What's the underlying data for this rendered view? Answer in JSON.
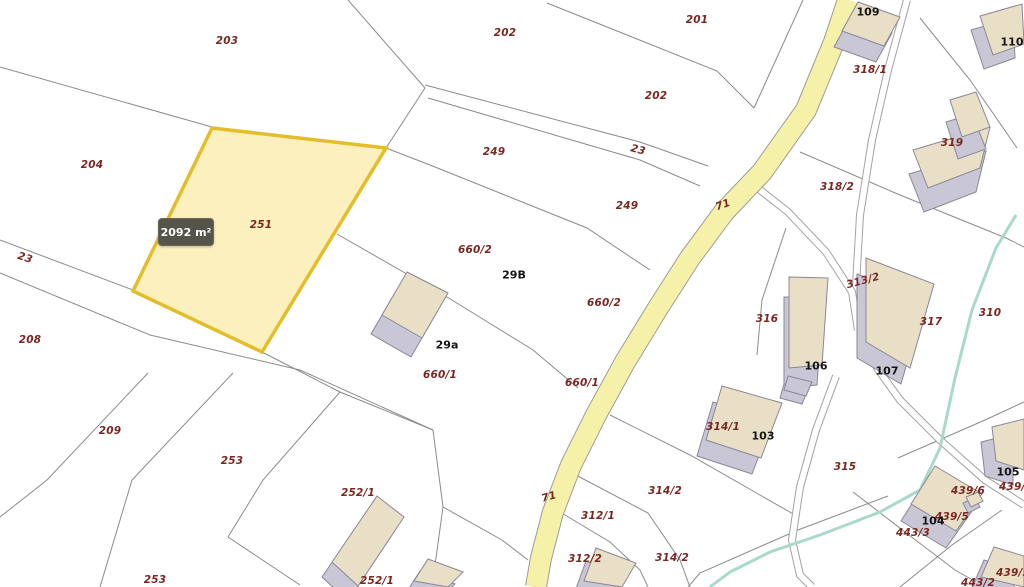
{
  "tooltip": {
    "area_label": "2092 m²"
  },
  "map": {
    "colors": {
      "background": "#ffffff",
      "boundary": "#8b8b8b",
      "road_fill": "#f6f1a8",
      "road_casing": "#9c9c9c",
      "path_edge": "#a2a2a2",
      "path_fill": "#ffffff",
      "stream": "#a9d9cb",
      "bldg_roof": "#e9dfc6",
      "bldg_side": "#c9c6d6",
      "bldg_edge": "#8a8795",
      "sel_fill": "#f6de6e",
      "sel_stroke": "#e4bd2a",
      "parcel_label": "#7a2721",
      "building_label": "#141414",
      "tooltip_bg": "#56544a"
    },
    "selected_parcel": {
      "id": "251",
      "area_label": "2092 m²",
      "points": [
        [
          212,
          128
        ],
        [
          386,
          148
        ],
        [
          262,
          352
        ],
        [
          133,
          291
        ]
      ]
    },
    "road": {
      "id": "71",
      "centerline": [
        [
          848,
          0
        ],
        [
          834,
          42
        ],
        [
          806,
          110
        ],
        [
          762,
          172
        ],
        [
          724,
          212
        ],
        [
          690,
          258
        ],
        [
          658,
          308
        ],
        [
          625,
          362
        ],
        [
          596,
          415
        ],
        [
          571,
          465
        ],
        [
          553,
          512
        ],
        [
          541,
          558
        ],
        [
          536,
          587
        ]
      ],
      "width": 20
    },
    "paths": [
      [
        [
          907,
          0
        ],
        [
          888,
          70
        ],
        [
          872,
          140
        ],
        [
          860,
          215
        ],
        [
          856,
          285
        ],
        [
          862,
          330
        ],
        [
          877,
          368
        ],
        [
          900,
          400
        ],
        [
          940,
          440
        ],
        [
          985,
          480
        ],
        [
          1024,
          505
        ]
      ],
      [
        [
          750,
          182
        ],
        [
          788,
          212
        ],
        [
          826,
          252
        ],
        [
          852,
          292
        ],
        [
          858,
          330
        ]
      ],
      [
        [
          836,
          376
        ],
        [
          816,
          430
        ],
        [
          800,
          487
        ],
        [
          792,
          540
        ],
        [
          800,
          575
        ],
        [
          812,
          587
        ]
      ]
    ],
    "stream": [
      [
        1016,
        215
      ],
      [
        996,
        248
      ],
      [
        972,
        310
      ],
      [
        955,
        378
      ],
      [
        940,
        448
      ],
      [
        920,
        490
      ],
      [
        880,
        512
      ],
      [
        820,
        535
      ],
      [
        770,
        552
      ],
      [
        730,
        572
      ],
      [
        710,
        587
      ]
    ],
    "boundaries": [
      [
        [
          0,
          67
        ],
        [
          212,
          127
        ]
      ],
      [
        [
          212,
          127
        ],
        [
          386,
          148
        ]
      ],
      [
        [
          348,
          0
        ],
        [
          425,
          88
        ]
      ],
      [
        [
          425,
          88
        ],
        [
          386,
          148
        ]
      ],
      [
        [
          547,
          3
        ],
        [
          717,
          71
        ],
        [
          754,
          108
        ]
      ],
      [
        [
          754,
          108
        ],
        [
          803,
          0
        ]
      ],
      [
        [
          425,
          85
        ],
        [
          640,
          142
        ],
        [
          708,
          166
        ]
      ],
      [
        [
          428,
          98
        ],
        [
          640,
          160
        ],
        [
          700,
          186
        ]
      ],
      [
        [
          386,
          148
        ],
        [
          430,
          165
        ],
        [
          587,
          228
        ],
        [
          650,
          270
        ]
      ],
      [
        [
          337,
          234
        ],
        [
          447,
          297
        ],
        [
          533,
          350
        ],
        [
          578,
          388
        ]
      ],
      [
        [
          0,
          240
        ],
        [
          133,
          290
        ]
      ],
      [
        [
          0,
          273
        ],
        [
          150,
          335
        ],
        [
          300,
          370
        ],
        [
          433,
          430
        ]
      ],
      [
        [
          262,
          352
        ],
        [
          340,
          392
        ],
        [
          433,
          430
        ]
      ],
      [
        [
          433,
          430
        ],
        [
          443,
          507
        ],
        [
          432,
          587
        ]
      ],
      [
        [
          443,
          507
        ],
        [
          502,
          540
        ],
        [
          528,
          560
        ]
      ],
      [
        [
          148,
          373
        ],
        [
          47,
          480
        ],
        [
          0,
          517
        ]
      ],
      [
        [
          233,
          373
        ],
        [
          132,
          480
        ],
        [
          100,
          587
        ]
      ],
      [
        [
          340,
          392
        ],
        [
          263,
          480
        ],
        [
          228,
          537
        ],
        [
          300,
          585
        ]
      ],
      [
        [
          920,
          18
        ],
        [
          970,
          80
        ],
        [
          1017,
          148
        ]
      ],
      [
        [
          800,
          152
        ],
        [
          900,
          195
        ],
        [
          1006,
          238
        ],
        [
          1024,
          247
        ]
      ],
      [
        [
          610,
          415
        ],
        [
          690,
          455
        ],
        [
          760,
          495
        ],
        [
          795,
          515
        ]
      ],
      [
        [
          572,
          473
        ],
        [
          648,
          513
        ],
        [
          680,
          560
        ],
        [
          690,
          587
        ]
      ],
      [
        [
          560,
          512
        ],
        [
          610,
          542
        ],
        [
          640,
          570
        ],
        [
          648,
          587
        ]
      ],
      [
        [
          888,
          496
        ],
        [
          798,
          530
        ],
        [
          700,
          573
        ],
        [
          688,
          587
        ]
      ],
      [
        [
          853,
          492
        ],
        [
          905,
          532
        ],
        [
          955,
          570
        ],
        [
          985,
          587
        ]
      ],
      [
        [
          898,
          458
        ],
        [
          985,
          420
        ]
      ],
      [
        [
          985,
          420
        ],
        [
          1024,
          402
        ]
      ],
      [
        [
          900,
          587
        ],
        [
          952,
          545
        ],
        [
          1002,
          510
        ]
      ],
      [
        [
          786,
          228
        ],
        [
          762,
          300
        ],
        [
          757,
          355
        ]
      ]
    ],
    "buildings": [
      {
        "n": "building-109",
        "roof": [
          [
            858,
            2
          ],
          [
            900,
            17
          ],
          [
            884,
            46
          ],
          [
            842,
            31
          ]
        ],
        "ex": [
          -8,
          16
        ]
      },
      {
        "n": "building-110",
        "roof": [
          [
            980,
            16
          ],
          [
            1022,
            4
          ],
          [
            1024,
            44
          ],
          [
            993,
            55
          ]
        ],
        "ex": [
          -9,
          14
        ]
      },
      {
        "n": "building-319-main",
        "roof": [
          [
            913,
            150
          ],
          [
            990,
            127
          ],
          [
            980,
            168
          ],
          [
            928,
            188
          ]
        ],
        "ex": [
          -4,
          24
        ]
      },
      {
        "n": "building-319-wing",
        "roof": [
          [
            950,
            100
          ],
          [
            976,
            92
          ],
          [
            990,
            127
          ],
          [
            962,
            137
          ]
        ],
        "ex": [
          -4,
          22
        ]
      },
      {
        "n": "building-29a",
        "roof": [
          [
            407,
            272
          ],
          [
            448,
            293
          ],
          [
            422,
            338
          ],
          [
            382,
            315
          ]
        ],
        "ex": [
          -11,
          19
        ]
      },
      {
        "n": "building-106",
        "roof": [
          [
            789,
            277
          ],
          [
            828,
            278
          ],
          [
            822,
            365
          ],
          [
            789,
            368
          ]
        ],
        "ex": [
          -5,
          20
        ]
      },
      {
        "n": "building-107",
        "roof": [
          [
            866,
            258
          ],
          [
            934,
            284
          ],
          [
            910,
            368
          ],
          [
            866,
            342
          ]
        ],
        "ex": [
          -9,
          16
        ]
      },
      {
        "n": "building-103",
        "roof": [
          [
            722,
            386
          ],
          [
            782,
            403
          ],
          [
            761,
            458
          ],
          [
            706,
            440
          ]
        ],
        "ex": [
          -9,
          16
        ]
      },
      {
        "n": "building-small-annex",
        "roof": [
          [
            788,
            376
          ],
          [
            812,
            382
          ],
          [
            806,
            396
          ],
          [
            784,
            390
          ]
        ],
        "ex": [
          -4,
          8
        ],
        "gray": true
      },
      {
        "n": "building-252",
        "roof": [
          [
            377,
            496
          ],
          [
            404,
            517
          ],
          [
            358,
            586
          ],
          [
            332,
            562
          ]
        ],
        "ex": [
          -10,
          15
        ]
      },
      {
        "n": "building-bottom-center",
        "roof": [
          [
            428,
            559
          ],
          [
            463,
            572
          ],
          [
            448,
            587
          ],
          [
            414,
            581
          ]
        ],
        "ex": [
          -8,
          12
        ]
      },
      {
        "n": "building-312",
        "roof": [
          [
            596,
            548
          ],
          [
            636,
            563
          ],
          [
            622,
            587
          ],
          [
            584,
            581
          ]
        ],
        "ex": [
          -10,
          13
        ]
      },
      {
        "n": "building-104",
        "roof": [
          [
            935,
            466
          ],
          [
            982,
            494
          ],
          [
            956,
            531
          ],
          [
            911,
            504
          ]
        ],
        "ex": [
          -10,
          17
        ]
      },
      {
        "n": "building-105",
        "roof": [
          [
            992,
            427
          ],
          [
            1024,
            419
          ],
          [
            1024,
            470
          ],
          [
            996,
            461
          ]
        ],
        "ex": [
          -11,
          15
        ]
      },
      {
        "n": "building-439-5",
        "roof": [
          [
            994,
            547
          ],
          [
            1024,
            556
          ],
          [
            1024,
            587
          ],
          [
            981,
            577
          ]
        ],
        "ex": [
          -10,
          13
        ]
      },
      {
        "n": "building-nub",
        "roof": [
          [
            966,
            497
          ],
          [
            978,
            492
          ],
          [
            983,
            501
          ],
          [
            971,
            507
          ]
        ],
        "ex": [
          -3,
          6
        ]
      }
    ],
    "labels": [
      {
        "t": "203",
        "x": 227,
        "y": 41,
        "c": "p"
      },
      {
        "t": "202",
        "x": 505,
        "y": 33,
        "c": "p"
      },
      {
        "t": "201",
        "x": 697,
        "y": 20,
        "c": "p"
      },
      {
        "t": "202",
        "x": 656,
        "y": 96,
        "c": "p"
      },
      {
        "t": "204",
        "x": 92,
        "y": 165,
        "c": "p"
      },
      {
        "t": "249",
        "x": 494,
        "y": 152,
        "c": "p"
      },
      {
        "t": "23",
        "x": 638,
        "y": 150,
        "c": "p",
        "r": 15
      },
      {
        "t": "249",
        "x": 627,
        "y": 206,
        "c": "p"
      },
      {
        "t": "318/1",
        "x": 870,
        "y": 70,
        "c": "p"
      },
      {
        "t": "319",
        "x": 952,
        "y": 143,
        "c": "p"
      },
      {
        "t": "318/2",
        "x": 837,
        "y": 187,
        "c": "p"
      },
      {
        "t": "71",
        "x": 723,
        "y": 205,
        "c": "p",
        "r": -20
      },
      {
        "t": "23",
        "x": 25,
        "y": 258,
        "c": "p",
        "r": 18
      },
      {
        "t": "251",
        "x": 261,
        "y": 225,
        "c": "p"
      },
      {
        "t": "660/2",
        "x": 475,
        "y": 250,
        "c": "p"
      },
      {
        "t": "660/2",
        "x": 604,
        "y": 303,
        "c": "p"
      },
      {
        "t": "313/2",
        "x": 863,
        "y": 281,
        "c": "p",
        "r": -15
      },
      {
        "t": "316",
        "x": 767,
        "y": 319,
        "c": "p"
      },
      {
        "t": "317",
        "x": 931,
        "y": 322,
        "c": "p"
      },
      {
        "t": "310",
        "x": 990,
        "y": 313,
        "c": "p"
      },
      {
        "t": "208",
        "x": 30,
        "y": 340,
        "c": "p"
      },
      {
        "t": "660/1",
        "x": 440,
        "y": 375,
        "c": "p"
      },
      {
        "t": "660/1",
        "x": 582,
        "y": 383,
        "c": "p"
      },
      {
        "t": "209",
        "x": 110,
        "y": 431,
        "c": "p"
      },
      {
        "t": "314/1",
        "x": 723,
        "y": 427,
        "c": "p"
      },
      {
        "t": "253",
        "x": 232,
        "y": 461,
        "c": "p"
      },
      {
        "t": "315",
        "x": 845,
        "y": 467,
        "c": "p"
      },
      {
        "t": "252/1",
        "x": 358,
        "y": 493,
        "c": "p"
      },
      {
        "t": "312/1",
        "x": 598,
        "y": 516,
        "c": "p"
      },
      {
        "t": "439/6",
        "x": 968,
        "y": 491,
        "c": "p"
      },
      {
        "t": "439/5",
        "x": 952,
        "y": 517,
        "c": "p"
      },
      {
        "t": "443/3",
        "x": 913,
        "y": 533,
        "c": "p"
      },
      {
        "t": "314/2",
        "x": 665,
        "y": 491,
        "c": "p"
      },
      {
        "t": "312/2",
        "x": 585,
        "y": 559,
        "c": "p"
      },
      {
        "t": "314/2",
        "x": 672,
        "y": 558,
        "c": "p"
      },
      {
        "t": "71",
        "x": 549,
        "y": 497,
        "c": "p",
        "r": -15
      },
      {
        "t": "439/4",
        "x": 1016,
        "y": 487,
        "c": "p"
      },
      {
        "t": "439/5",
        "x": 1013,
        "y": 573,
        "c": "p"
      },
      {
        "t": "443/2",
        "x": 978,
        "y": 583,
        "c": "p"
      },
      {
        "t": "252/1",
        "x": 377,
        "y": 581,
        "c": "p"
      },
      {
        "t": "253",
        "x": 155,
        "y": 580,
        "c": "p"
      },
      {
        "t": "109",
        "x": 868,
        "y": 12,
        "c": "b"
      },
      {
        "t": "110",
        "x": 1012,
        "y": 42,
        "c": "b"
      },
      {
        "t": "29B",
        "x": 514,
        "y": 275,
        "c": "b"
      },
      {
        "t": "29a",
        "x": 447,
        "y": 345,
        "c": "b"
      },
      {
        "t": "106",
        "x": 816,
        "y": 366,
        "c": "b"
      },
      {
        "t": "107",
        "x": 887,
        "y": 371,
        "c": "b"
      },
      {
        "t": "103",
        "x": 763,
        "y": 436,
        "c": "b"
      },
      {
        "t": "105",
        "x": 1008,
        "y": 472,
        "c": "b"
      },
      {
        "t": "104",
        "x": 933,
        "y": 521,
        "c": "b"
      }
    ]
  }
}
